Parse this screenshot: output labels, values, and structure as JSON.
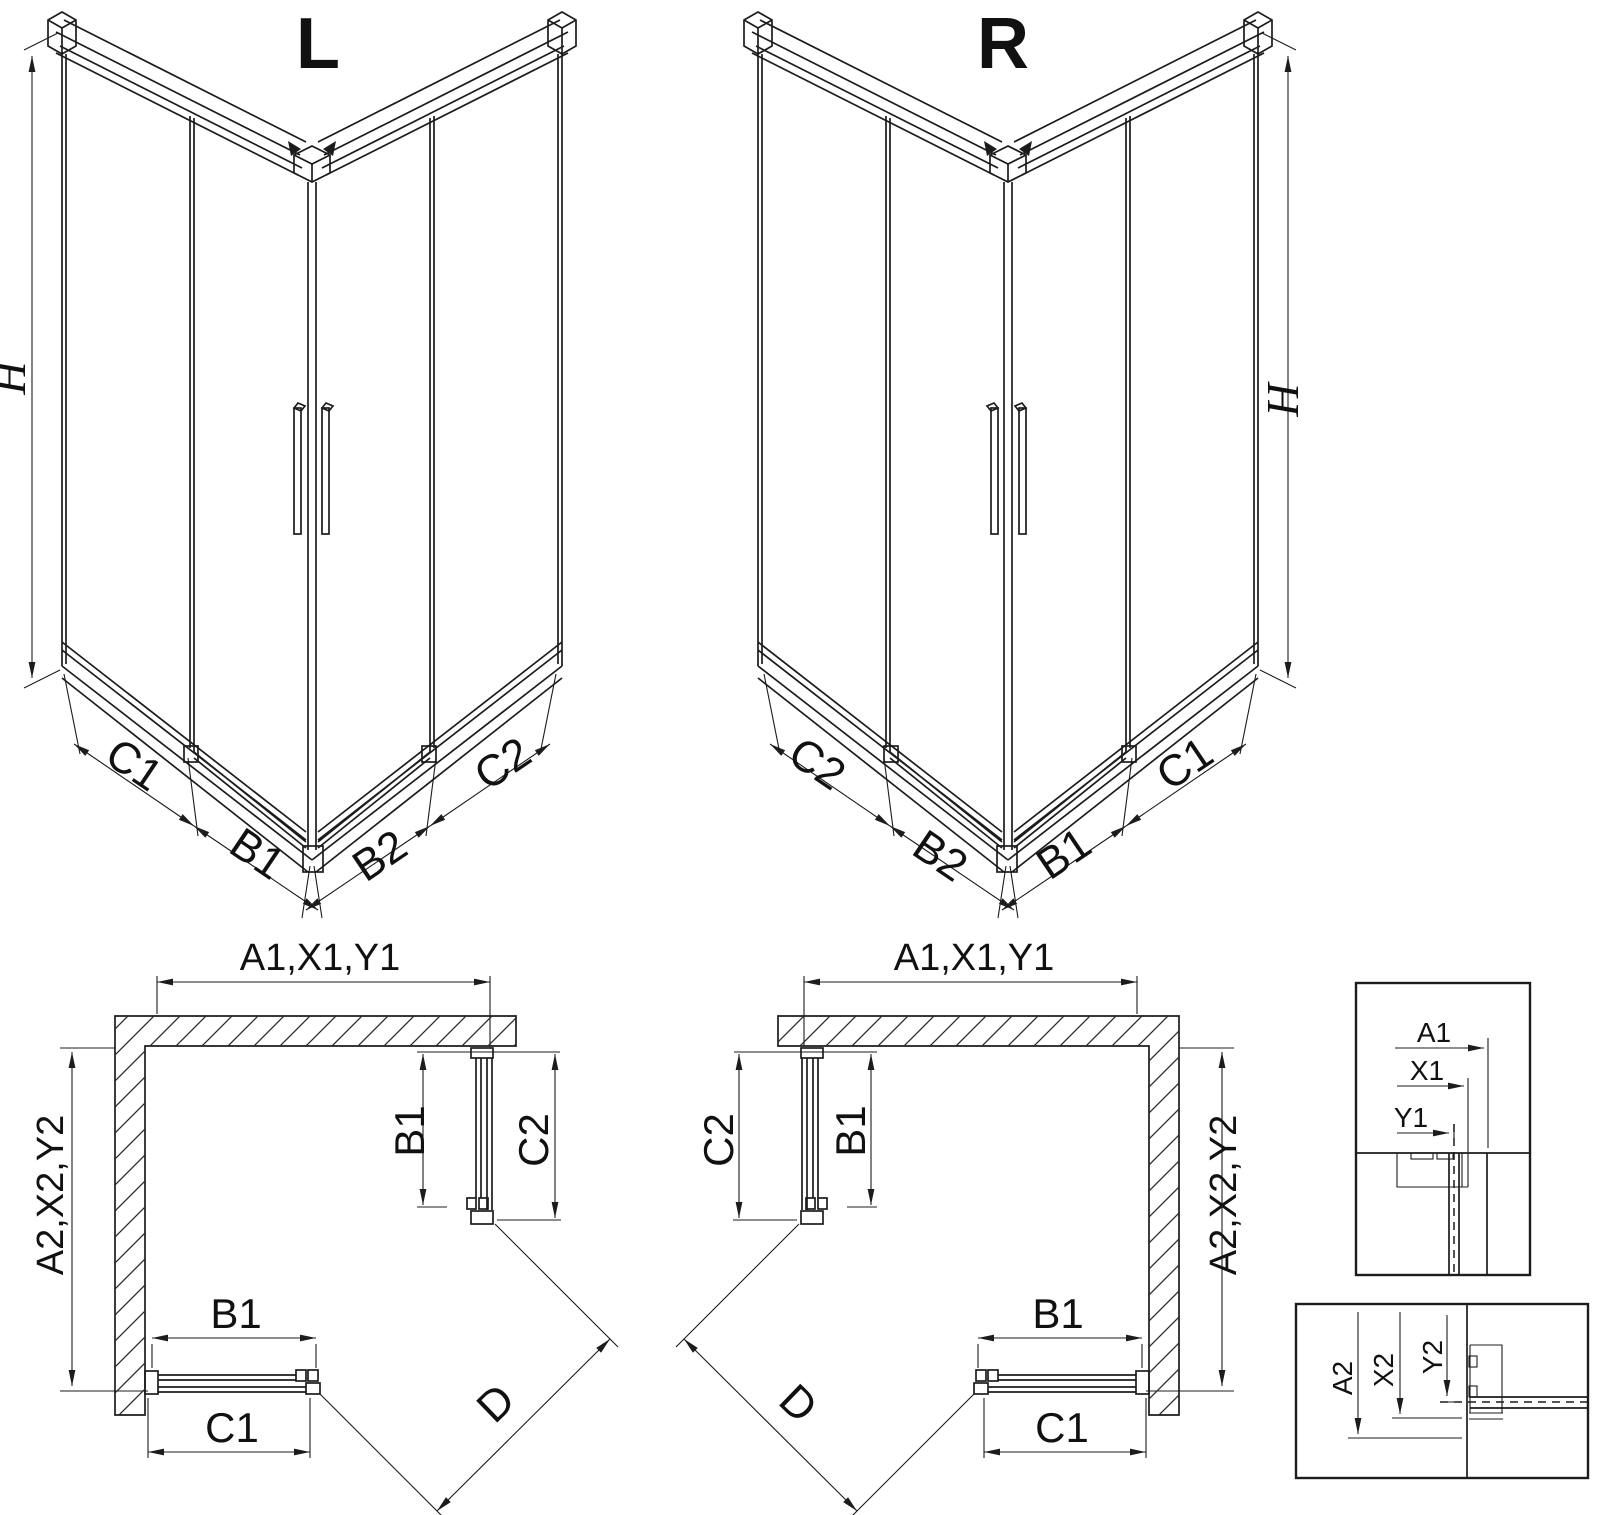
{
  "page": {
    "background": "#ffffff",
    "line_color": "#1c1c1c"
  },
  "iso_left": {
    "label": "L",
    "height_dim": "H",
    "bottom_dims": [
      "C1",
      "B1",
      "B2",
      "C2"
    ]
  },
  "iso_right": {
    "label": "R",
    "height_dim": "H",
    "bottom_dims": [
      "C2",
      "B2",
      "B1",
      "C1"
    ]
  },
  "plan_left": {
    "top_dim": "A1,X1,Y1",
    "side_dim": "A2,X2,Y2",
    "door_side": "B1",
    "fixed_side": "C2",
    "door_bottom": "B1",
    "fixed_bottom": "C1",
    "diagonal": "D"
  },
  "plan_right": {
    "top_dim": "A1,X1,Y1",
    "side_dim": "A2,X2,Y2",
    "door_side": "B1",
    "fixed_side": "C2",
    "door_bottom": "B1",
    "fixed_bottom": "C1",
    "diagonal": "D"
  },
  "detail_top": {
    "dim_a": "A1",
    "dim_x": "X1",
    "dim_y": "Y1"
  },
  "detail_bottom": {
    "dim_a": "A2",
    "dim_x": "X2",
    "dim_y": "Y2"
  }
}
